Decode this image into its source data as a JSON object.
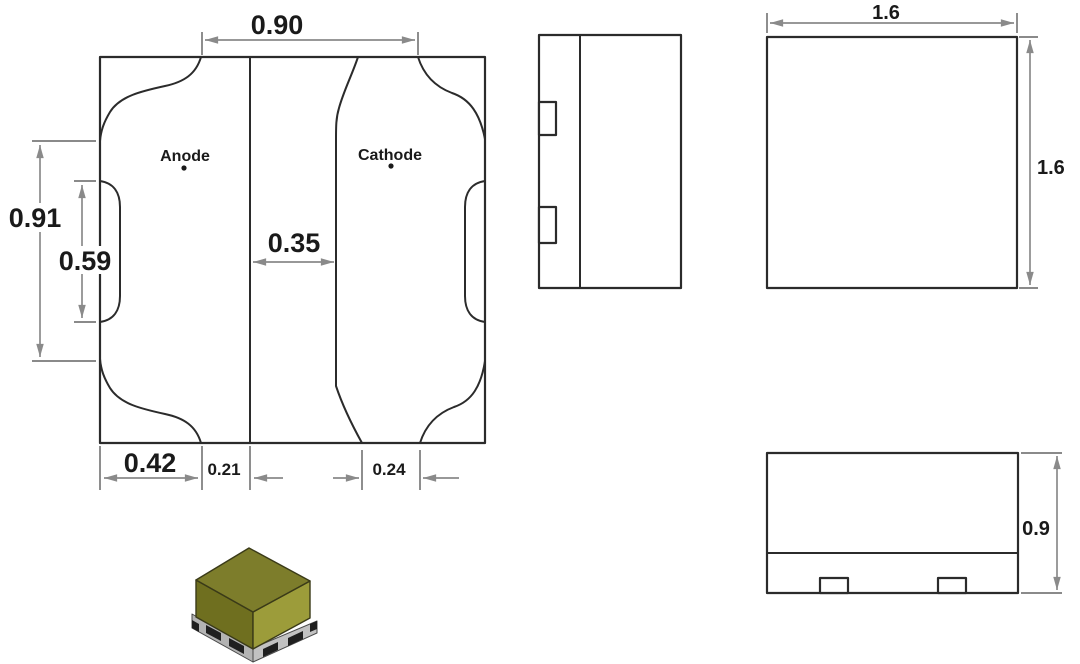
{
  "drawing": {
    "bottom_view": {
      "anode_label": "Anode",
      "cathode_label": "Cathode",
      "dim_top_width": "0.90",
      "dim_outer_height": "0.91",
      "dim_notch_height": "0.59",
      "dim_pad_gap": "0.35",
      "dim_anode_pad_width": "0.42",
      "dim_anode_inner_offset": "0.21",
      "dim_cathode_inner_offset": "0.24"
    },
    "top_view": {
      "dim_width": "1.6",
      "dim_height": "1.6"
    },
    "front_view": {
      "dim_height": "0.9"
    }
  },
  "colors": {
    "outline": "#2b2b2b",
    "dimension_line": "#8a8a8a",
    "text": "#1a1a1a",
    "background": "#ffffff",
    "led_top": "#7d7d2b",
    "led_left": "#6f6f1f",
    "led_right": "#9c9c3a",
    "base_left": "#b3b3b3",
    "base_right": "#c2c2c2",
    "pad_dark": "#1f1f1f"
  }
}
